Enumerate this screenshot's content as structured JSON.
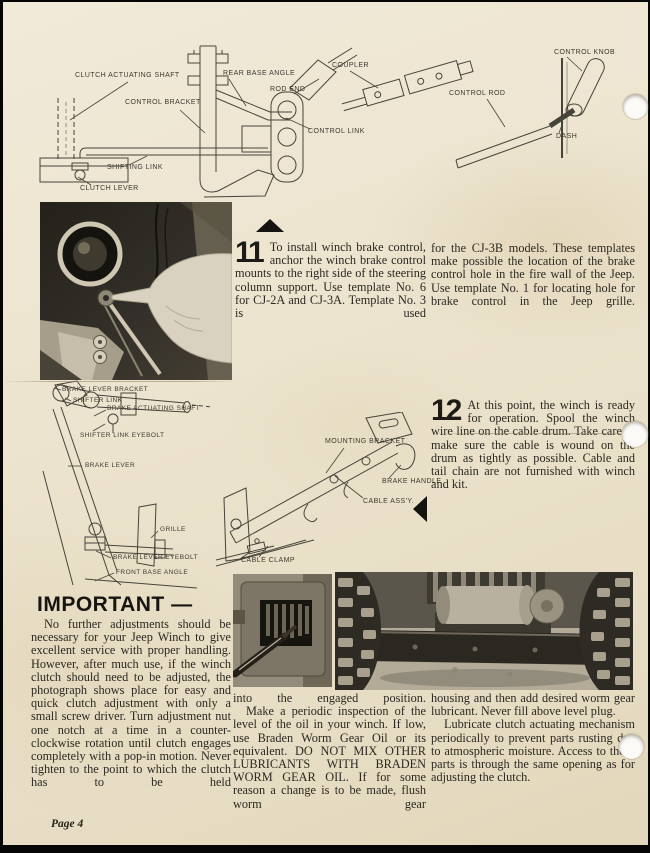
{
  "diagram_top": {
    "clutch_actuating_shaft": "CLUTCH ACTUATING SHAFT",
    "rear_base_angle": "REAR BASE ANGLE",
    "control_bracket": "CONTROL BRACKET",
    "rod_end": "ROD END",
    "control_link": "CONTROL LINK",
    "shifting_link": "SHIFTING LINK",
    "clutch_lever": "CLUTCH LEVER",
    "coupler": "COUPLER",
    "control_rod": "CONTROL ROD",
    "control_knob": "CONTROL KNOB",
    "dash": "DASH"
  },
  "diagram_brake": {
    "brake_lever_bracket": "BRAKE LEVER BRACKET",
    "shifter_link": "SHIFTER LINK",
    "brake_actuating_shaft": "BRAKE ACTUATING SHAFT",
    "shifter_link_eyebolt": "SHIFTER LINK EYEBOLT",
    "brake_lever": "BRAKE LEVER",
    "grille": "GRILLE",
    "brake_lever_eyebolt": "BRAKE LEVER EYEBOLT",
    "front_base_angle": "FRONT BASE ANGLE"
  },
  "diagram_winch": {
    "mounting_bracket": "MOUNTING BRACKET",
    "brake_handle": "BRAKE HANDLE",
    "cable_assy": "CABLE ASS'Y.",
    "cable_clamp": "CABLE CLAMP"
  },
  "step11": {
    "number": "11",
    "col1": "To install winch brake control, anchor the winch brake control mounts to the right side of the steering column support. Use template No. 6 for CJ-2A and CJ-3A. Template No. 3 is used",
    "col2": "for the CJ-3B models. These templates make possible the location of the brake control hole in the fire wall of the Jeep. Use template No. 1 for locating hole for brake control in the Jeep grille."
  },
  "step12": {
    "number": "12",
    "text": "At this point, the winch is ready for operation. Spool the winch wire line on the cable drum. Take care to make sure the cable is wound on the drum as tightly as possible. Cable and tail chain are not furnished with winch and kit."
  },
  "important": {
    "heading": "IMPORTANT —",
    "body": "No further adjustments should be necessary for your Jeep Winch to give excellent service with proper handling. However, after much use, if the winch clutch should need to be adjusted, the photograph shows place for easy and quick clutch adjustment with only a small screw driver. Turn adjustment nut one notch at a time in a counter-clockwise rotation until clutch engages completely with a pop-in motion. Never tighten to the point to which the clutch has to be held"
  },
  "bottom_left_col": {
    "p1": "into the engaged position.",
    "p2": "Make a periodic inspection of the level of the oil in your winch. If low, use Braden Worm Gear Oil or its equivalent. DO NOT MIX OTHER LUBRICANTS WITH BRADEN WORM GEAR OIL. If for some reason a change is to be made, flush worm gear"
  },
  "bottom_right_col": {
    "p1": "housing and then add desired worm gear lubricant. Never fill above level plug.",
    "p2": "Lubricate clutch actuating mechanism periodically to prevent parts rusting due to atmospheric moisture. Access to these parts is through the same opening as for adjusting the clutch."
  },
  "footer": {
    "page_label": "Page 4"
  }
}
